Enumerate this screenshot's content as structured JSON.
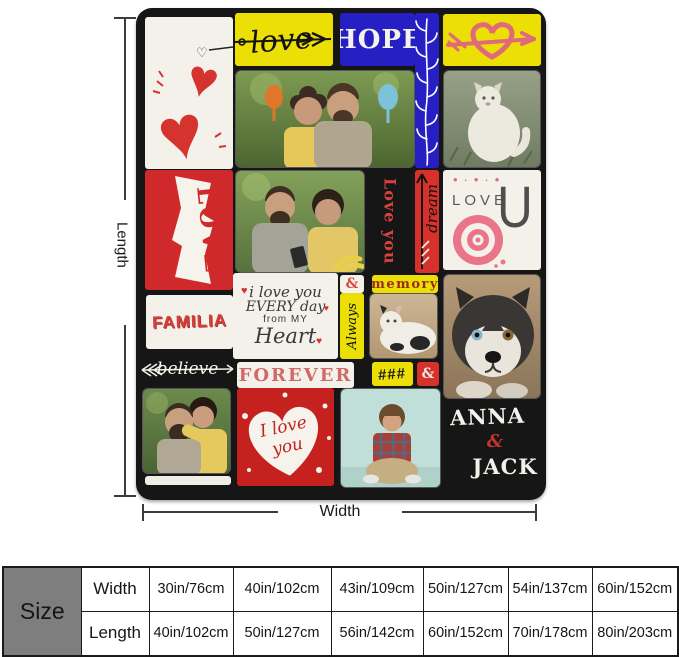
{
  "product_diagram": {
    "length_label": "Length",
    "width_label": "Width",
    "tiles": {
      "love_script": "love",
      "hope": "HOPE",
      "love_ribbon": "LOVE",
      "love_you": "Love you",
      "dream": "dream",
      "love_u_word": "LOVE",
      "love_u_letter": "U",
      "amp_small": "&",
      "memory": "memory",
      "familia": "FAMILIA",
      "ily_line1": "i love you",
      "ily_line2": "EVERY day",
      "ily_line3": "from MY",
      "ily_line4": "Heart",
      "always": "Always",
      "believe": "believe",
      "forever": "FOREVER",
      "hash": "###",
      "amp_red": "&",
      "heart_line1": "I love",
      "heart_line2": "you",
      "name_top": "ANNA",
      "name_amp": "&",
      "name_bottom": "JACK"
    },
    "photos": {
      "toasting_couple": "couple-toasting-photo",
      "white_cat": "white-cat-photo",
      "couple_phone": "couple-with-phone-photo",
      "small_cat": "lying-cat-photo",
      "husky": "husky-dog-photo",
      "hugging_couple": "hugging-couple-photo",
      "boy": "sitting-boy-photo"
    }
  },
  "size_table": {
    "corner_label": "Size",
    "rows": [
      {
        "label": "Width",
        "values": [
          "30in/76cm",
          "40in/102cm",
          "43in/109cm",
          "50in/127cm",
          "54in/137cm",
          "60in/152cm"
        ]
      },
      {
        "label": "Length",
        "values": [
          "40in/102cm",
          "50in/127cm",
          "56in/142cm",
          "60in/152cm",
          "70in/178cm",
          "80in/203cm"
        ]
      }
    ]
  },
  "colors": {
    "tile_yellow": "#ecdf05",
    "tile_blue": "#2620c4",
    "tile_red": "#d0292b",
    "blanket_black": "#161616",
    "accent_pink": "#e06a79",
    "forever_pink": "#d06a67",
    "table_gray": "#7e7e7e"
  }
}
